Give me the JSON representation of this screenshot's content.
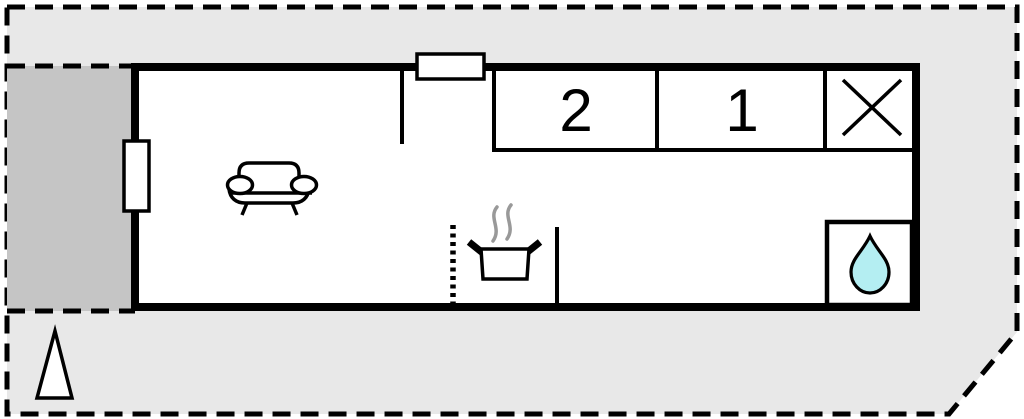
{
  "floorplan": {
    "rooms": [
      {
        "id": "bedroom-2",
        "label": "2"
      },
      {
        "id": "bedroom-1",
        "label": "1"
      }
    ],
    "symbols": {
      "skylight_cross": "x-cross-icon",
      "sofa": "sofa-icon",
      "cooking_pot": "cooking-pot-icon",
      "steam": "steam-waves-icon",
      "water_drop": "water-drop-icon",
      "north_triangle": "triangle-north-icon",
      "window": "window-rect-icon"
    },
    "colors": {
      "plot_background": "#e8e8e8",
      "terrace": "#c5c5c5",
      "wall": "#000000",
      "interior": "#ffffff",
      "water_drop": "#b4eef2",
      "steam": "#999999"
    }
  }
}
